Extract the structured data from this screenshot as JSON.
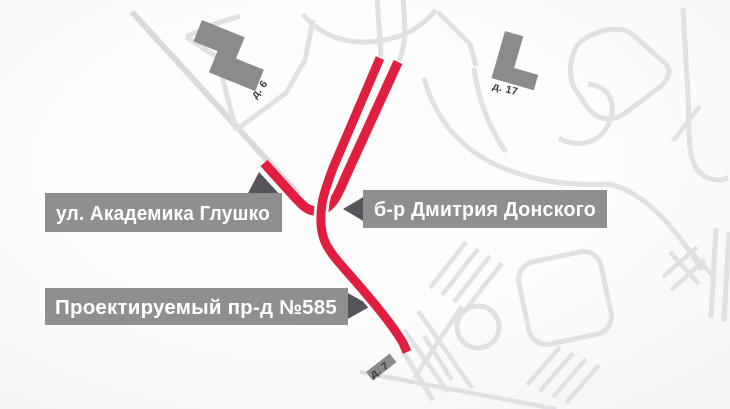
{
  "map": {
    "type": "street-scheme",
    "street_labels": [
      {
        "id": "glushko",
        "text": "ул. Академика Глушко"
      },
      {
        "id": "donskogo",
        "text": "б-р Дмитрия Донского"
      },
      {
        "id": "proezd",
        "text": "Проектируемый пр-д №585"
      }
    ],
    "building_captions": [
      {
        "id": "house-6",
        "text": "д. 6"
      },
      {
        "id": "house-17",
        "text": "д. 17"
      },
      {
        "id": "house-7",
        "text": "д. 7"
      }
    ],
    "colors": {
      "background_center": "#fdfdfe",
      "background_edge": "#e7e7ec",
      "road_gray": "#e0e0e5",
      "highlight_red": "#e01f3e",
      "building_gray": "#8b8b8e",
      "label_background": "#8f8f92",
      "label_pointer": "#55555a",
      "label_text": "#ffffff",
      "caption_text": "#38383b"
    }
  }
}
